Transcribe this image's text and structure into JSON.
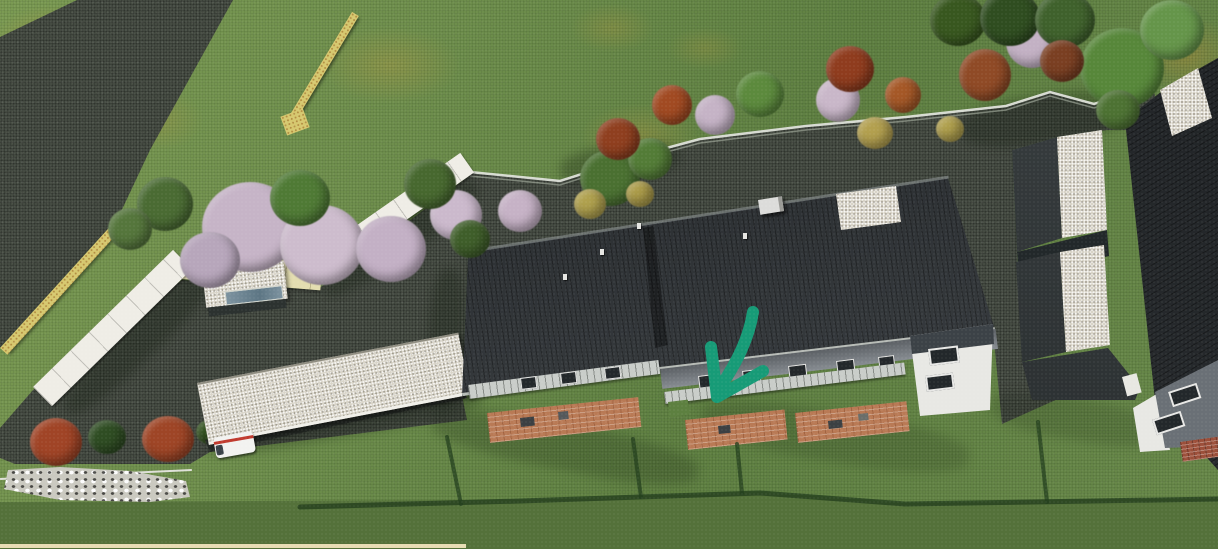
{
  "scene": {
    "type": "aerial-3d-architectural-rendering",
    "title": "",
    "visible_text": [],
    "annotation_arrow": {
      "meaning": "marks the middle terrace unit of the duplex house",
      "color": "#179b77"
    },
    "palette": {
      "lawn": "#6f8f4d",
      "lawn_shade": "#5a7a3e",
      "lawn_dark": "#54713a",
      "asphalt": "#454b42",
      "asphalt_dark": "#363c35",
      "roof_dark": "#32373b",
      "roof_light": "#d8d4c8",
      "wall_white": "#efede6",
      "wall_cream": "#e3ddb0",
      "wall_yellow": "#d6c86f",
      "brick_patio": "#b97a55",
      "brick_wall": "#9c4f3a",
      "railing": "#c9cdc9",
      "facade": "#7a8086",
      "fence": "#dfe3da",
      "rocks": "#cac9c0",
      "bush_red": "#a04426",
      "blossom": "#c6b4c7",
      "tree_green": "#4d7233",
      "tree_bright": "#5f8c3e",
      "hedge": "#24401e",
      "van_white": "#f2f2f0",
      "van_stripe": "#c03a2e",
      "bottom_wall": "#e6dcb4"
    },
    "objects": [
      {
        "name": "lawn",
        "desc": "green grass with dry yellow patches"
      },
      {
        "name": "access-road",
        "desc": "dark asphalt strip entering from top-left"
      },
      {
        "name": "driveway",
        "desc": "large dark asphalt court between houses"
      },
      {
        "name": "boundary-fence",
        "desc": "light picket fence along the north edge of the driveway"
      },
      {
        "name": "tree-row",
        "desc": "mixed green, autumn-red and blossom trees"
      },
      {
        "name": "noise-barrier-wall",
        "desc": "white segmented wall zig-zagging at the west corner"
      },
      {
        "name": "yellow-garden-wall",
        "desc": "two yellow masonry wall segments"
      },
      {
        "name": "garden-shed",
        "desc": "small gravel-roofed shelter with glass skylight"
      },
      {
        "name": "carport",
        "desc": "long gravel-roofed carport"
      },
      {
        "name": "parked-van",
        "desc": "white van with red stripe under carport"
      },
      {
        "name": "rock-bed",
        "desc": "white rock riprap strip at bottom-left"
      },
      {
        "name": "red-shrubs",
        "desc": "two red-orange shrubs beside the rocks"
      },
      {
        "name": "main-duplex-house",
        "desc": "long dark-roofed multi-unit house with terraces and brick patios"
      },
      {
        "name": "chimney",
        "desc": "white chimney on dark roof"
      },
      {
        "name": "garden-hedges",
        "desc": "dark hedge lines dividing the gardens"
      },
      {
        "name": "neighbor-house-east",
        "desc": "dark-roofed house at right edge with two gravel-roofed garages"
      },
      {
        "name": "annotation-arrow",
        "desc": "hand-drawn teal arrow pointing at middle unit terrace"
      }
    ]
  }
}
